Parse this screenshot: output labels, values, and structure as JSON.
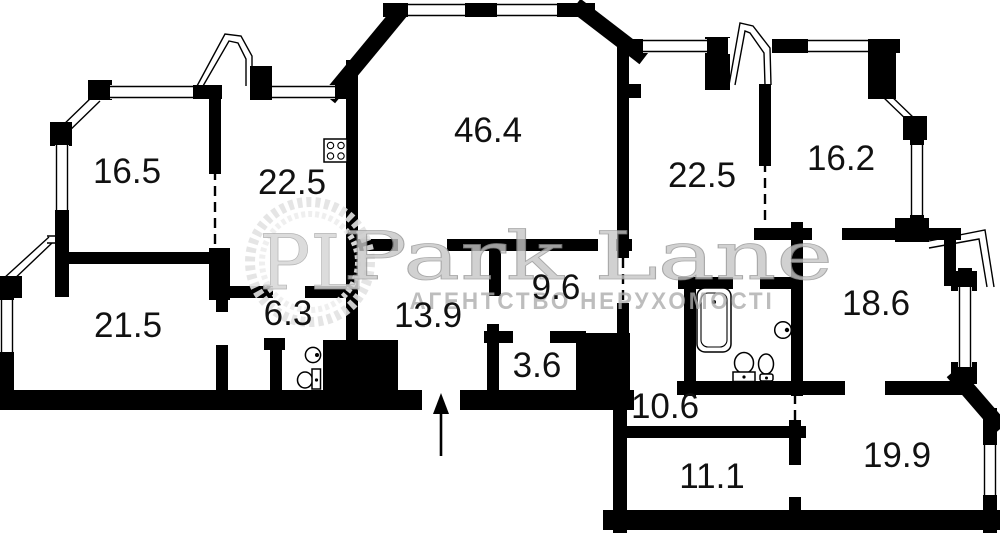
{
  "plan": {
    "rooms": [
      {
        "area": "16.5"
      },
      {
        "area": "22.5"
      },
      {
        "area": "46.4"
      },
      {
        "area": "22.5"
      },
      {
        "area": "16.2"
      },
      {
        "area": "21.5"
      },
      {
        "area": "6.3"
      },
      {
        "area": "13.9"
      },
      {
        "area": "9.6"
      },
      {
        "area": "3.6"
      },
      {
        "area": "18.6"
      },
      {
        "area": "10.6"
      },
      {
        "area": "11.1"
      },
      {
        "area": "19.9"
      }
    ],
    "icons": [
      "stove-icon",
      "bathtub-icon",
      "pedestal-sink-icon",
      "toilet-icon",
      "round-wall-sink-icon",
      "wc-sink-icon",
      "wc-toilet-icon",
      "entrance-arrow-icon"
    ]
  },
  "watermark": {
    "logo_text": "PL",
    "brand": "Park Lane",
    "subtitle": "АГЕНТСТВО НЕРУХОМОСТІ"
  },
  "colors": {
    "walls": "#000000",
    "room_labels": "#111111",
    "watermark_text": "#c6c6c6",
    "watermark_subtitle": "#adadad",
    "background": "#ffffff"
  }
}
